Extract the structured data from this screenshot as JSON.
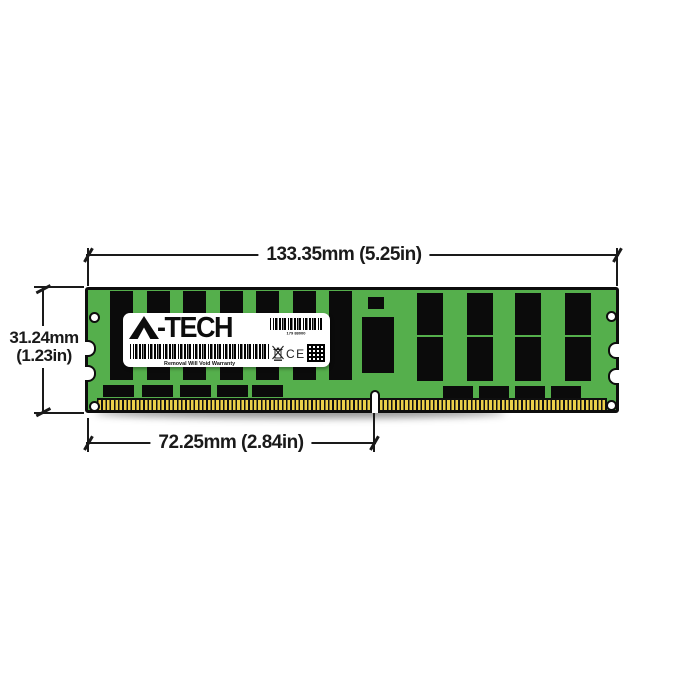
{
  "annotations": {
    "width_label": "133.35mm (5.25in)",
    "height_label_mm": "31.24mm",
    "height_label_in": "(1.23in)",
    "pin_label": "72.25mm (2.84in)"
  },
  "label": {
    "brand_full": "A-TECH",
    "brand_text": "-TECH",
    "barcode_number": "179 88000",
    "warranty_text": "Removal Will Void Warranty",
    "ce_mark": "CE"
  },
  "colors": {
    "pcb_green": "#55AF4C",
    "chip_black": "#0b0b0b",
    "pin_gold": "#ecd04a",
    "annotation_black": "#1a1a1a",
    "label_white": "#ffffff"
  },
  "module_geometry": {
    "tall_chips_left": {
      "xs": [
        22,
        58.5,
        95,
        131.5,
        168,
        204.5,
        241
      ],
      "y": 1,
      "w": 23,
      "h": 89
    },
    "split_chips_right": {
      "xs": [
        329,
        379,
        427,
        477
      ],
      "w": 26,
      "top": {
        "y": 3,
        "h": 42
      },
      "bottom": {
        "y": 47,
        "h": 44
      }
    },
    "small_chips_left": {
      "xs": [
        15,
        54,
        92,
        129,
        164
      ],
      "y": 95,
      "w": 31,
      "h": 12
    },
    "small_chips_right": {
      "xs": [
        355,
        391,
        427,
        463
      ],
      "y": 96,
      "w": 30,
      "h": 12
    },
    "center_square": {
      "x": 280,
      "y": 7,
      "w": 16,
      "h": 12
    },
    "register_chip": {
      "x": 274,
      "y": 27,
      "w": 32,
      "h": 56
    },
    "holes": [
      {
        "x": 6,
        "y": 27
      },
      {
        "x": 6,
        "y": 116
      },
      {
        "x": 523,
        "y": 26
      },
      {
        "x": 523,
        "y": 115
      }
    ],
    "left_notches_y": [
      50,
      75
    ],
    "right_notches_y": [
      52,
      78
    ]
  }
}
